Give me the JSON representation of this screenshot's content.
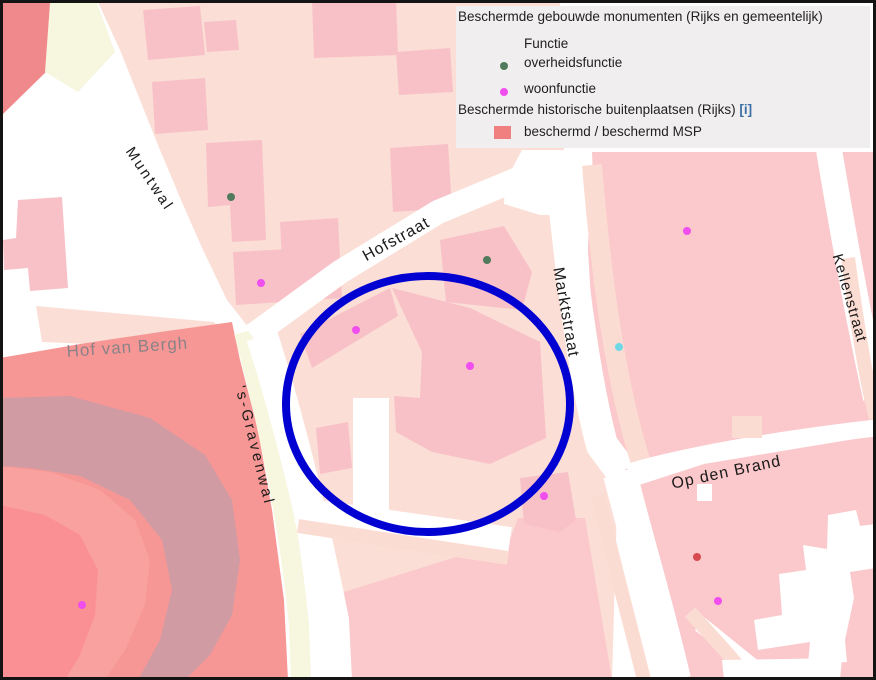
{
  "legend": {
    "title_monuments": "Beschermde gebouwde monumenten (Rijks en gemeentelijk)",
    "group_label": "Functie",
    "items": [
      {
        "label": "overheidsfunctie",
        "color": "#527a5c",
        "type": "overheidsfunctie"
      },
      {
        "label": "woonfunctie",
        "color": "#f04eee",
        "type": "woonfunctie"
      }
    ],
    "title_buitenplaatsen": "Beschermde historische buitenplaatsen (Rijks)",
    "info_link": "[i]",
    "info_color": "#3c6fa5",
    "swatch": {
      "label": "beschermd / beschermd MSP",
      "color": "#f08080"
    }
  },
  "map": {
    "streets": [
      {
        "name": "Muntwal"
      },
      {
        "name": "Hofstraat"
      },
      {
        "name": "Hof van Bergh"
      },
      {
        "name": "'s-Gravenwal"
      },
      {
        "name": "Marktstraat"
      },
      {
        "name": "Kellenstraat"
      },
      {
        "name": "Op den Brand"
      }
    ],
    "dot_colors": {
      "overheidsfunctie": "#527a5c",
      "woonfunctie": "#f04eee",
      "other-cyan": "#6fd7e6",
      "other-red": "#d84a50"
    },
    "monuments": [
      {
        "x": 231,
        "y": 197,
        "type": "overheidsfunctie"
      },
      {
        "x": 261,
        "y": 283,
        "type": "woonfunctie"
      },
      {
        "x": 487,
        "y": 260,
        "type": "overheidsfunctie"
      },
      {
        "x": 356,
        "y": 330,
        "type": "woonfunctie"
      },
      {
        "x": 470,
        "y": 366,
        "type": "woonfunctie"
      },
      {
        "x": 544,
        "y": 496,
        "type": "woonfunctie"
      },
      {
        "x": 687,
        "y": 231,
        "type": "woonfunctie"
      },
      {
        "x": 619,
        "y": 347,
        "type": "other-cyan"
      },
      {
        "x": 697,
        "y": 557,
        "type": "other-red"
      },
      {
        "x": 718,
        "y": 601,
        "type": "woonfunctie"
      },
      {
        "x": 82,
        "y": 605,
        "type": "woonfunctie"
      }
    ],
    "annotation_circle": {
      "cx": 428,
      "cy": 404,
      "rx": 142,
      "ry": 128,
      "color": "#0101d2",
      "stroke_width": 8
    },
    "colors": {
      "pale_area": "#fbded5",
      "block_pink": "#fbc8cb",
      "building_pink": "#f8c1c7",
      "salmon": "#f79795",
      "mauve_band": "#d09ba3",
      "salmon_ring": "#f9a19e",
      "inner_pink": "#fa9094",
      "cream_path": "#f7f6df",
      "road_white": "#ffffff",
      "legend_bg": "#f0eeee"
    }
  }
}
